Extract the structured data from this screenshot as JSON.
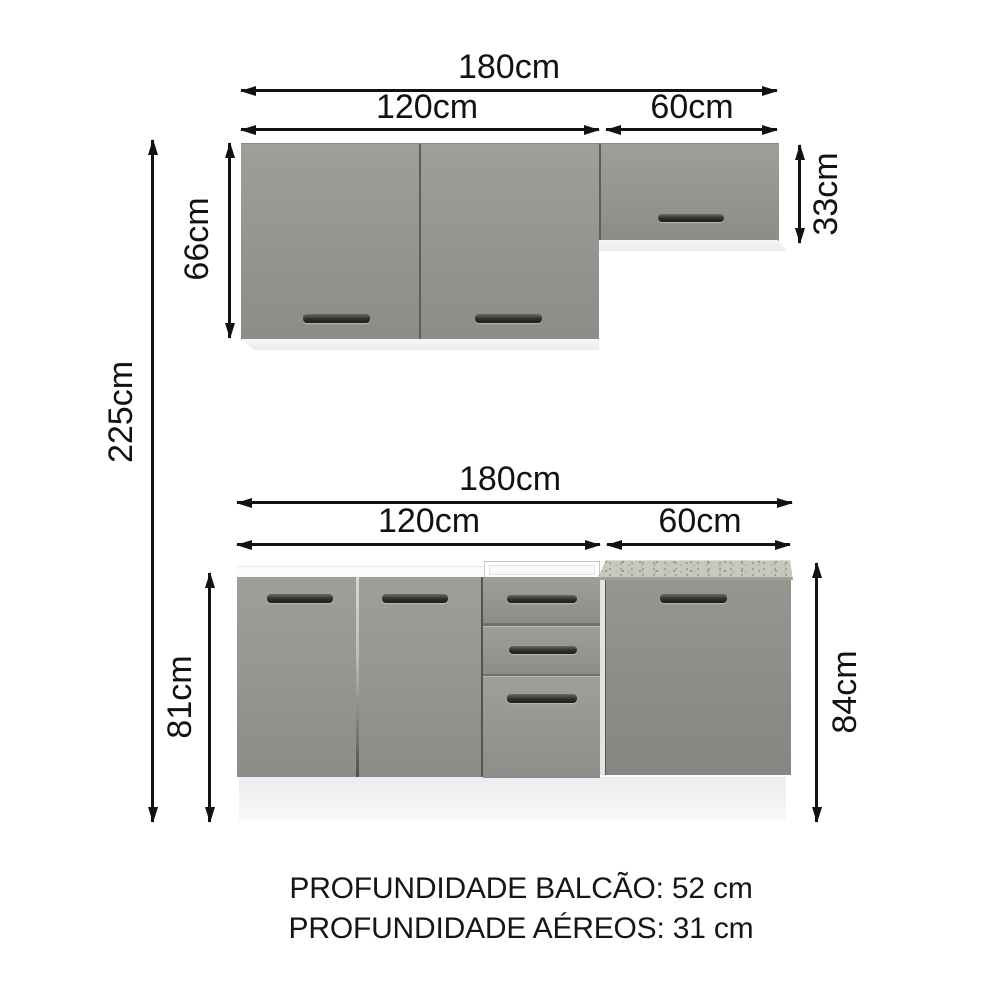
{
  "dimensions": {
    "upper_total_width": "180cm",
    "upper_left_width": "120cm",
    "upper_right_width": "60cm",
    "upper_left_height": "66cm",
    "upper_right_height": "33cm",
    "overall_height": "225cm",
    "lower_total_width": "180cm",
    "lower_left_width": "120cm",
    "lower_right_width": "60cm",
    "lower_left_height": "81cm",
    "lower_right_height": "84cm"
  },
  "footer": {
    "counter_depth": "PROFUNDIDADE BALCÃO: 52 cm",
    "upper_depth": "PROFUNDIDADE AÉREOS: 31 cm"
  },
  "colors": {
    "cabinet_gray": "#94958f",
    "handle_dark": "#2e2e2b",
    "countertop_speckled": "#c6cabc",
    "plinth_white": "#f0f1f3",
    "dimension_black": "#121212",
    "background": "#ffffff"
  }
}
